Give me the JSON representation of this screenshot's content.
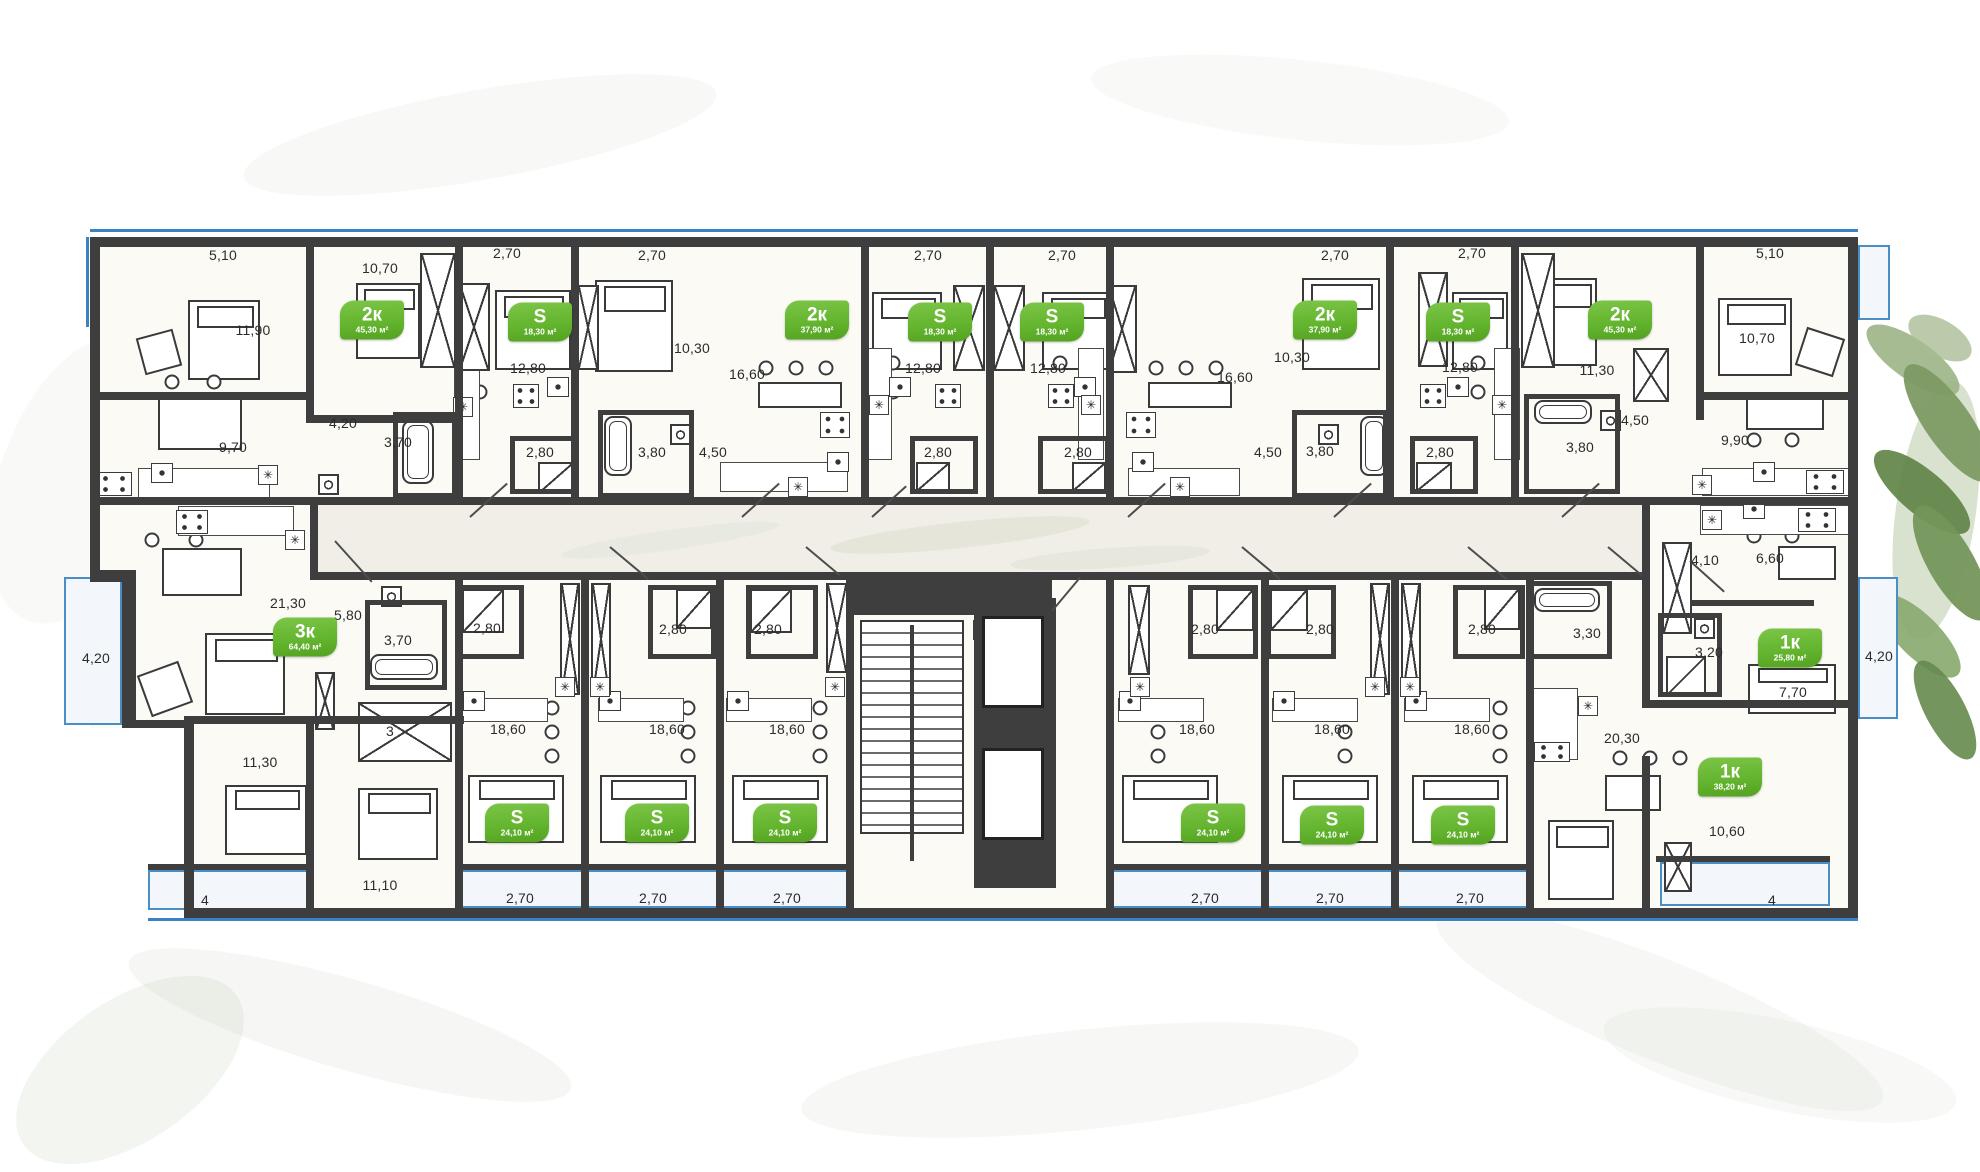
{
  "plan": {
    "accent_green": "#64b52f",
    "wall_color": "#3e3e3e",
    "outline_blue": "#3b82c4",
    "room_fill": "#fbfaf5"
  },
  "icons": {
    "fridge": "✳"
  },
  "badges": [
    {
      "type": "2к",
      "area": "45,30 м²",
      "x": 372,
      "y": 320
    },
    {
      "type": "S",
      "area": "18,30 м²",
      "x": 540,
      "y": 322
    },
    {
      "type": "2к",
      "area": "37,90 м²",
      "x": 817,
      "y": 320
    },
    {
      "type": "S",
      "area": "18,30 м²",
      "x": 940,
      "y": 322
    },
    {
      "type": "S",
      "area": "18,30 м²",
      "x": 1052,
      "y": 322
    },
    {
      "type": "2к",
      "area": "37,90 м²",
      "x": 1325,
      "y": 320
    },
    {
      "type": "S",
      "area": "18,30 м²",
      "x": 1458,
      "y": 322
    },
    {
      "type": "2к",
      "area": "45,30 м²",
      "x": 1620,
      "y": 320
    },
    {
      "type": "3к",
      "area": "64,40 м²",
      "x": 305,
      "y": 637
    },
    {
      "type": "1к",
      "area": "25,80 м²",
      "x": 1790,
      "y": 648
    },
    {
      "type": "1к",
      "area": "38,20 м²",
      "x": 1730,
      "y": 777
    },
    {
      "type": "S",
      "area": "24,10 м²",
      "x": 517,
      "y": 823
    },
    {
      "type": "S",
      "area": "24,10 м²",
      "x": 657,
      "y": 823
    },
    {
      "type": "S",
      "area": "24,10 м²",
      "x": 785,
      "y": 823
    },
    {
      "type": "S",
      "area": "24,10 м²",
      "x": 1213,
      "y": 823
    },
    {
      "type": "S",
      "area": "24,10 м²",
      "x": 1332,
      "y": 825
    },
    {
      "type": "S",
      "area": "24,10 м²",
      "x": 1463,
      "y": 825
    }
  ],
  "dims": [
    {
      "t": "5,10",
      "x": 223,
      "y": 255
    },
    {
      "t": "10,70",
      "x": 380,
      "y": 268
    },
    {
      "t": "2,70",
      "x": 507,
      "y": 253
    },
    {
      "t": "2,70",
      "x": 652,
      "y": 255
    },
    {
      "t": "2,70",
      "x": 928,
      "y": 255
    },
    {
      "t": "2,70",
      "x": 1062,
      "y": 255
    },
    {
      "t": "2,70",
      "x": 1335,
      "y": 255
    },
    {
      "t": "2,70",
      "x": 1472,
      "y": 253
    },
    {
      "t": "5,10",
      "x": 1770,
      "y": 253
    },
    {
      "t": "11,90",
      "x": 253,
      "y": 330
    },
    {
      "t": "12,80",
      "x": 528,
      "y": 368
    },
    {
      "t": "10,30",
      "x": 692,
      "y": 348
    },
    {
      "t": "16,60",
      "x": 747,
      "y": 374
    },
    {
      "t": "12,80",
      "x": 923,
      "y": 368
    },
    {
      "t": "12,80",
      "x": 1048,
      "y": 368
    },
    {
      "t": "16,60",
      "x": 1235,
      "y": 377
    },
    {
      "t": "10,30",
      "x": 1292,
      "y": 357
    },
    {
      "t": "12,80",
      "x": 1460,
      "y": 367
    },
    {
      "t": "11,30",
      "x": 1597,
      "y": 370
    },
    {
      "t": "10,70",
      "x": 1757,
      "y": 338
    },
    {
      "t": "9,70",
      "x": 233,
      "y": 447
    },
    {
      "t": "4,20",
      "x": 343,
      "y": 423
    },
    {
      "t": "3,70",
      "x": 398,
      "y": 442
    },
    {
      "t": "2,80",
      "x": 540,
      "y": 452
    },
    {
      "t": "3,80",
      "x": 652,
      "y": 452
    },
    {
      "t": "4,50",
      "x": 713,
      "y": 452
    },
    {
      "t": "2,80",
      "x": 938,
      "y": 452
    },
    {
      "t": "2,80",
      "x": 1078,
      "y": 452
    },
    {
      "t": "4,50",
      "x": 1268,
      "y": 452
    },
    {
      "t": "3,80",
      "x": 1320,
      "y": 451
    },
    {
      "t": "2,80",
      "x": 1440,
      "y": 452
    },
    {
      "t": "3,80",
      "x": 1580,
      "y": 447
    },
    {
      "t": "4,50",
      "x": 1635,
      "y": 420
    },
    {
      "t": "9,90",
      "x": 1735,
      "y": 440
    },
    {
      "t": "4,20",
      "x": 96,
      "y": 658
    },
    {
      "t": "21,30",
      "x": 288,
      "y": 603
    },
    {
      "t": "5,80",
      "x": 348,
      "y": 615
    },
    {
      "t": "3,70",
      "x": 398,
      "y": 640
    },
    {
      "t": "3",
      "x": 390,
      "y": 731
    },
    {
      "t": "11,30",
      "x": 260,
      "y": 762
    },
    {
      "t": "11,10",
      "x": 380,
      "y": 885
    },
    {
      "t": "4",
      "x": 205,
      "y": 900
    },
    {
      "t": "2,80",
      "x": 487,
      "y": 628
    },
    {
      "t": "2,80",
      "x": 673,
      "y": 629
    },
    {
      "t": "2,80",
      "x": 768,
      "y": 629
    },
    {
      "t": "18,60",
      "x": 508,
      "y": 729
    },
    {
      "t": "18,60",
      "x": 667,
      "y": 729
    },
    {
      "t": "18,60",
      "x": 787,
      "y": 729
    },
    {
      "t": "2,70",
      "x": 520,
      "y": 898
    },
    {
      "t": "2,70",
      "x": 653,
      "y": 898
    },
    {
      "t": "2,70",
      "x": 787,
      "y": 898
    },
    {
      "t": "2,80",
      "x": 1205,
      "y": 629
    },
    {
      "t": "2,80",
      "x": 1320,
      "y": 629
    },
    {
      "t": "2,80",
      "x": 1482,
      "y": 629
    },
    {
      "t": "18,60",
      "x": 1197,
      "y": 729
    },
    {
      "t": "18,60",
      "x": 1332,
      "y": 729
    },
    {
      "t": "18,60",
      "x": 1472,
      "y": 729
    },
    {
      "t": "2,70",
      "x": 1205,
      "y": 898
    },
    {
      "t": "2,70",
      "x": 1330,
      "y": 898
    },
    {
      "t": "2,70",
      "x": 1470,
      "y": 898
    },
    {
      "t": "4,10",
      "x": 1705,
      "y": 560
    },
    {
      "t": "6,60",
      "x": 1770,
      "y": 558
    },
    {
      "t": "3,20",
      "x": 1709,
      "y": 652
    },
    {
      "t": "7,70",
      "x": 1793,
      "y": 692
    },
    {
      "t": "4,20",
      "x": 1879,
      "y": 656
    },
    {
      "t": "3,30",
      "x": 1587,
      "y": 633
    },
    {
      "t": "20,30",
      "x": 1622,
      "y": 738
    },
    {
      "t": "10,60",
      "x": 1727,
      "y": 831
    },
    {
      "t": "4",
      "x": 1772,
      "y": 900
    }
  ]
}
